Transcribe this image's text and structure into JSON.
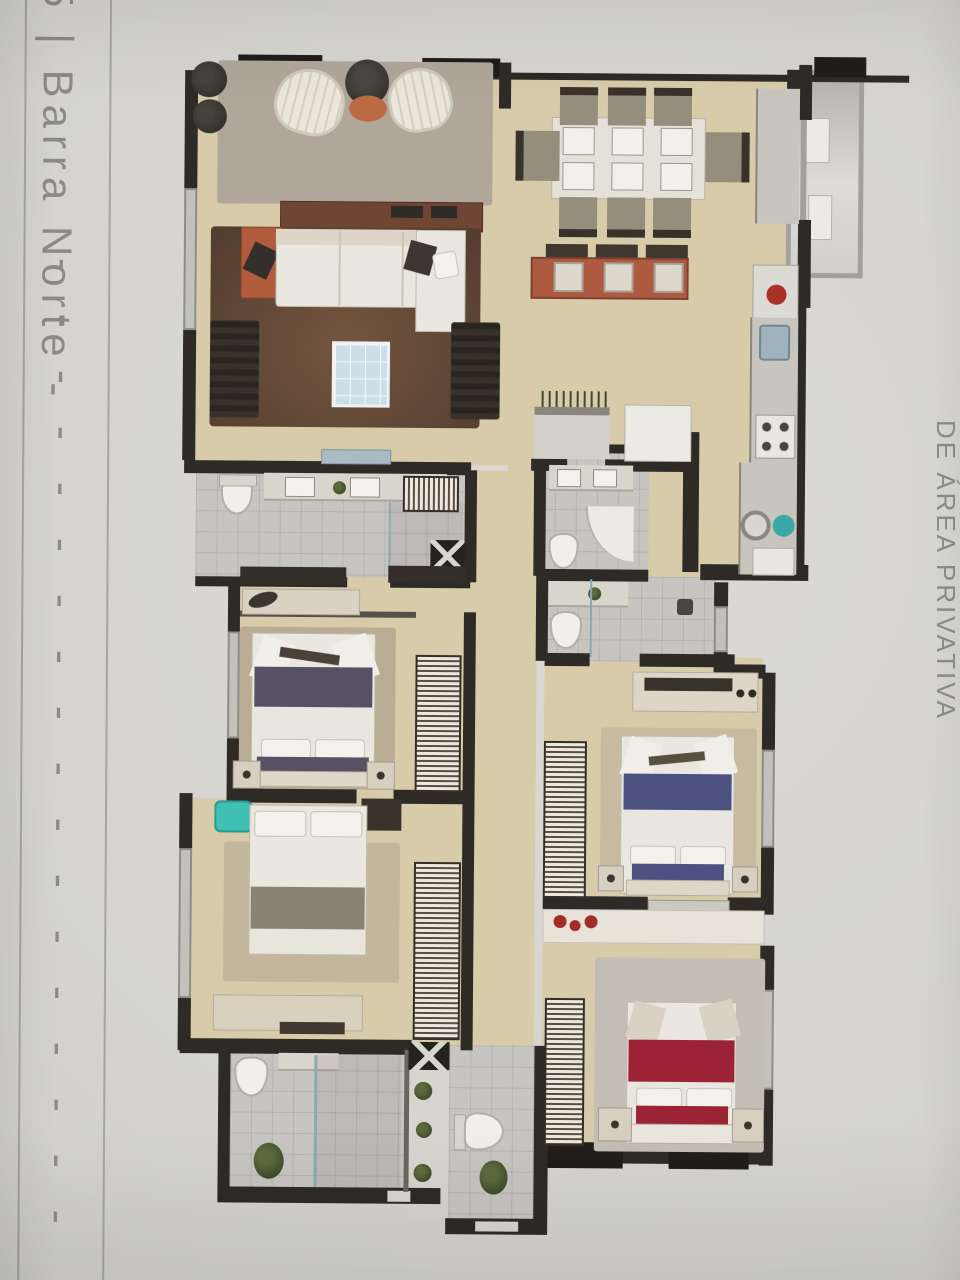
{
  "page": {
    "left_margin": {
      "label": "5 | Barra Norte -",
      "dashes": "------------------"
    },
    "right_caption": {
      "label": "DE ÁREA PRIVATIVA"
    },
    "colors": {
      "paper": "#d3d2ce",
      "rule_lines": "#97968f",
      "caption_text": "#8b8a86",
      "plan_wall": "#2e2a25",
      "floor_beige": "#d7cbaa",
      "tile_gray": "#c7c5c1",
      "rug_brown": "#6a4e3c",
      "terrace_rug_gray": "#b0a79a",
      "accent_orange": "#b55f3d",
      "bar_counter_red": "#ad5a40",
      "master_bed_purple": "#575165",
      "bed_blue": "#4c5180",
      "bed_red": "#9c2335",
      "teal_chair": "#3fc0b2",
      "teal_sink": "#3aa9a6",
      "coffee_table_glass": "#cddee9"
    }
  }
}
